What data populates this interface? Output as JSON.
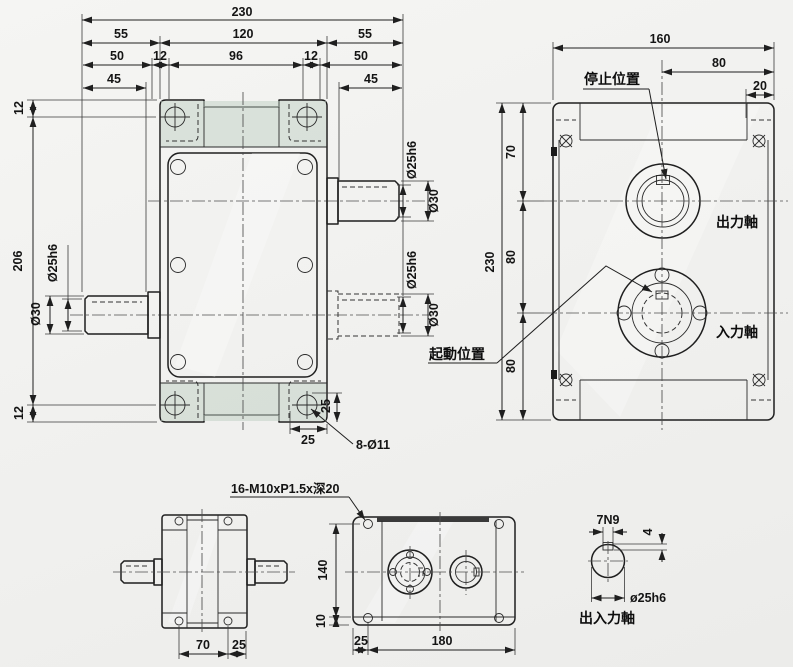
{
  "front_view": {
    "d_overall_w": "230",
    "d_w55l": "55",
    "d_w120": "120",
    "d_w55r": "55",
    "d_50l": "50",
    "d_12l": "12",
    "d_96": "96",
    "d_12r": "12",
    "d_50r": "50",
    "d_45l": "45",
    "d_45r": "45",
    "d_12t": "12",
    "d_206": "206",
    "d_12b": "12",
    "left_shaft_dia": "Ø25h6",
    "left_shaft_shoulder": "Ø30",
    "out_shaft_dia": "Ø25h6",
    "out_shaft_shoulder": "Ø30",
    "in_shaft_dia": "Ø25h6",
    "in_shaft_shoulder": "Ø30",
    "d_25v": "25",
    "d_25h": "25",
    "hole_note": "8-Ø11"
  },
  "side_view": {
    "d_160": "160",
    "d_80t": "80",
    "d_20": "20",
    "d_230": "230",
    "d_70": "70",
    "d_80m": "80",
    "d_80b": "80",
    "stop_position": "停止位置",
    "start_position": "起動位置",
    "output_shaft": "出力軸",
    "input_shaft": "入力軸"
  },
  "end_view": {
    "d_70": "70",
    "d_25": "25"
  },
  "bottom_view": {
    "tap_note": "16-M10xP1.5x深20",
    "d_140": "140",
    "d_10": "10",
    "d_25": "25",
    "d_180": "180"
  },
  "shaft_section": {
    "key_width": "7N9",
    "key_depth": "4",
    "dia": "ø25h6",
    "label": "出入力軸"
  },
  "colors": {
    "background": "#f1f1ef",
    "body_green_light": "#e2ebe2",
    "body_green_dark": "#b4c7ba",
    "line": "#1f1f1f"
  }
}
